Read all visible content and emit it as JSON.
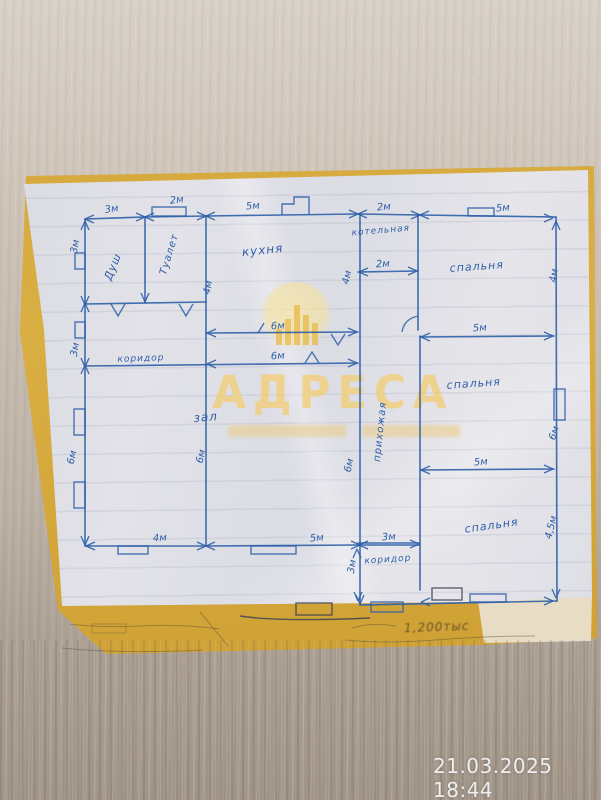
{
  "photo": {
    "timestamp": "21.03.2025 18:44"
  },
  "watermark": {
    "title": "АДРЕСА"
  },
  "floor_plan": {
    "handwritten_note": "1,200тыс",
    "room_labels": [
      {
        "id": "dush",
        "text": "Душ",
        "x": 116,
        "y": 268,
        "rot": -68,
        "size": 11
      },
      {
        "id": "tualet",
        "text": "Туалет",
        "x": 172,
        "y": 255,
        "rot": -73,
        "size": 10
      },
      {
        "id": "kuhnya",
        "text": "кухня",
        "x": 263,
        "y": 254,
        "rot": -6,
        "size": 12
      },
      {
        "id": "kotelnaya",
        "text": "котельная",
        "x": 381,
        "y": 233,
        "rot": -5,
        "size": 9
      },
      {
        "id": "spalnya-1",
        "text": "спальня",
        "x": 477,
        "y": 270,
        "rot": -4,
        "size": 11
      },
      {
        "id": "spalnya-2",
        "text": "спальня",
        "x": 474,
        "y": 387,
        "rot": -4,
        "size": 11
      },
      {
        "id": "spalnya-3",
        "text": "спальня",
        "x": 492,
        "y": 529,
        "rot": -8,
        "size": 11
      },
      {
        "id": "koridor",
        "text": "коридор",
        "x": 141,
        "y": 361,
        "rot": -2,
        "size": 9
      },
      {
        "id": "zal",
        "text": "зал",
        "x": 206,
        "y": 421,
        "rot": -5,
        "size": 12
      },
      {
        "id": "prihozhaya",
        "text": "прихожая",
        "x": 383,
        "y": 432,
        "rot": -84,
        "size": 10
      },
      {
        "id": "koridor-2",
        "text": "коридор",
        "x": 388,
        "y": 562,
        "rot": -4,
        "size": 9
      }
    ],
    "dimension_labels": [
      {
        "text": "3м",
        "x": 112,
        "y": 212,
        "rot": -8
      },
      {
        "text": "2м",
        "x": 177,
        "y": 203,
        "rot": -6
      },
      {
        "text": "5м",
        "x": 253,
        "y": 209,
        "rot": -4
      },
      {
        "text": "2м",
        "x": 384,
        "y": 210,
        "rot": -4
      },
      {
        "text": "5м",
        "x": 503,
        "y": 211,
        "rot": -4
      },
      {
        "text": "3м",
        "x": 78,
        "y": 247,
        "rot": -80
      },
      {
        "text": "3м",
        "x": 78,
        "y": 350,
        "rot": -80
      },
      {
        "text": "6м",
        "x": 75,
        "y": 458,
        "rot": -78
      },
      {
        "text": "4м",
        "x": 211,
        "y": 288,
        "rot": -80
      },
      {
        "text": "6м",
        "x": 278,
        "y": 329,
        "rot": -3
      },
      {
        "text": "6м",
        "x": 278,
        "y": 359,
        "rot": -3
      },
      {
        "text": "2м",
        "x": 383,
        "y": 267,
        "rot": -3
      },
      {
        "text": "4м",
        "x": 350,
        "y": 278,
        "rot": -78
      },
      {
        "text": "4м",
        "x": 557,
        "y": 276,
        "rot": -82
      },
      {
        "text": "5м",
        "x": 480,
        "y": 331,
        "rot": -3
      },
      {
        "text": "6м",
        "x": 557,
        "y": 434,
        "rot": -72
      },
      {
        "text": "5м",
        "x": 481,
        "y": 465,
        "rot": -4
      },
      {
        "text": "4,5м",
        "x": 554,
        "y": 528,
        "rot": -76
      },
      {
        "text": "6м",
        "x": 204,
        "y": 457,
        "rot": -78
      },
      {
        "text": "6м",
        "x": 352,
        "y": 466,
        "rot": -78
      },
      {
        "text": "4м",
        "x": 160,
        "y": 541,
        "rot": -3
      },
      {
        "text": "5м",
        "x": 317,
        "y": 541,
        "rot": -4
      },
      {
        "text": "3м",
        "x": 389,
        "y": 540,
        "rot": -3
      },
      {
        "text": "3м",
        "x": 355,
        "y": 567,
        "rot": -80
      }
    ]
  }
}
